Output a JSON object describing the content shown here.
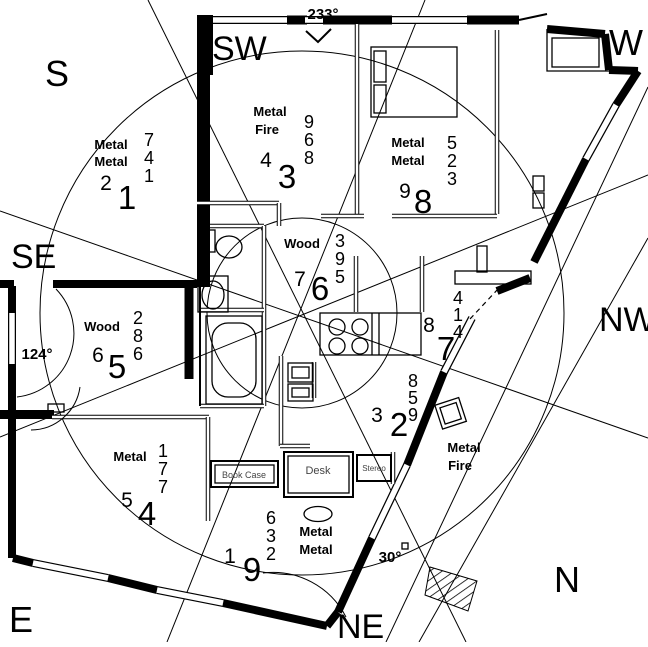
{
  "compass": {
    "labels": {
      "s": "S",
      "sw": "SW",
      "w": "W",
      "se": "SE",
      "nw": "NW",
      "e": "E",
      "ne": "NE",
      "n": "N"
    },
    "degrees": {
      "top": "233°",
      "left": "124°",
      "bottom": "30°"
    }
  },
  "sectors": {
    "s": {
      "elements": [
        "Metal",
        "Metal"
      ],
      "column": [
        "7",
        "4",
        "1"
      ],
      "medium": "2",
      "large": "1"
    },
    "sw": {
      "elements": [
        "Metal",
        "Fire"
      ],
      "column": [
        "9",
        "6",
        "8"
      ],
      "medium": "4",
      "large": "3"
    },
    "w": {
      "elements": [
        "Metal",
        "Metal"
      ],
      "column": [
        "5",
        "2",
        "3"
      ],
      "medium": "9",
      "large": "8"
    },
    "se": {
      "elements": [
        "Wood"
      ],
      "column": [
        "2",
        "8",
        "6"
      ],
      "medium": "6",
      "large": "5"
    },
    "center": {
      "elements": [
        "Wood"
      ],
      "column": [
        "3",
        "9",
        "5"
      ],
      "medium": "7",
      "large": "6"
    },
    "nw": {
      "elements": [],
      "column": [
        "4",
        "1",
        "4"
      ],
      "medium": "8",
      "large": "7"
    },
    "e": {
      "elements": [
        "Metal"
      ],
      "column": [
        "1",
        "7",
        "7"
      ],
      "medium": "5",
      "large": "4"
    },
    "ne": {
      "elements": [
        "Metal",
        "Metal"
      ],
      "column": [
        "6",
        "3",
        "2"
      ],
      "medium": "1",
      "large": "9"
    },
    "n": {
      "elements": [
        "Metal",
        "Fire"
      ],
      "column": [
        "8",
        "5",
        "9"
      ],
      "medium": "3",
      "large": "2"
    }
  },
  "furniture": {
    "desk": "Desk",
    "bookcase": "Book Case",
    "stereo": "Stereo"
  },
  "colors": {
    "wall": "#000000",
    "background": "#ffffff"
  }
}
